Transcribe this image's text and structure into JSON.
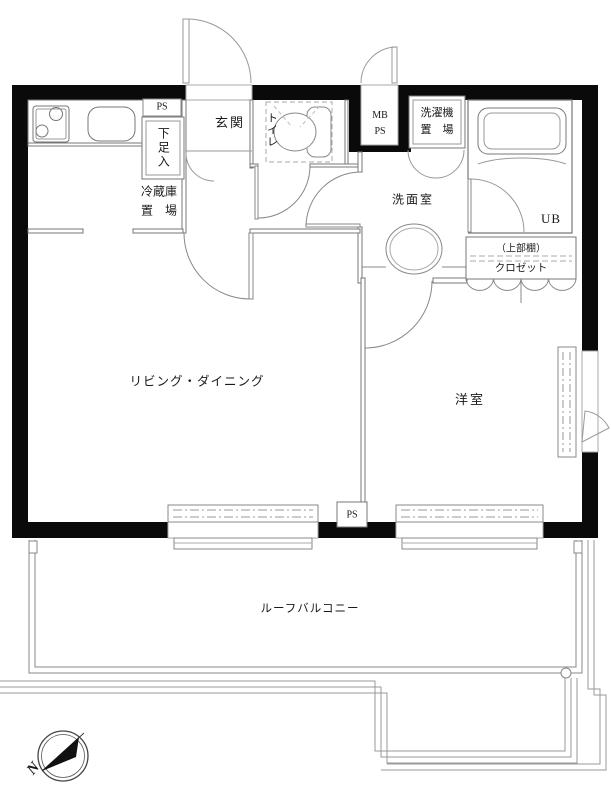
{
  "plan_type": "apartment-floor-plan",
  "colors": {
    "wall": "#0a0a0a",
    "line": "#777777",
    "light_line": "#999999",
    "text": "#1a1a1a",
    "bg": "#ffffff"
  },
  "rooms": {
    "pipe_space_top": "PS",
    "shoe_cabinet": "下足入",
    "entrance": "玄関",
    "toilet": "トイレ",
    "fridge_space_line1": "冷蔵庫",
    "fridge_space_line2": "置　場",
    "meter_box_line1": "MB",
    "meter_box_line2": "PS",
    "washer_space_line1": "洗濯機",
    "washer_space_line2": "置　場",
    "washroom": "洗面室",
    "unit_bath": "UB",
    "closet_upper_shelf": "（上部棚）",
    "closet": "クロゼット",
    "living_dining": "リビング・ダイニング",
    "western_room": "洋室",
    "pipe_space_bottom": "PS",
    "roof_balcony": "ルーフバルコニー",
    "compass_north": "N"
  }
}
